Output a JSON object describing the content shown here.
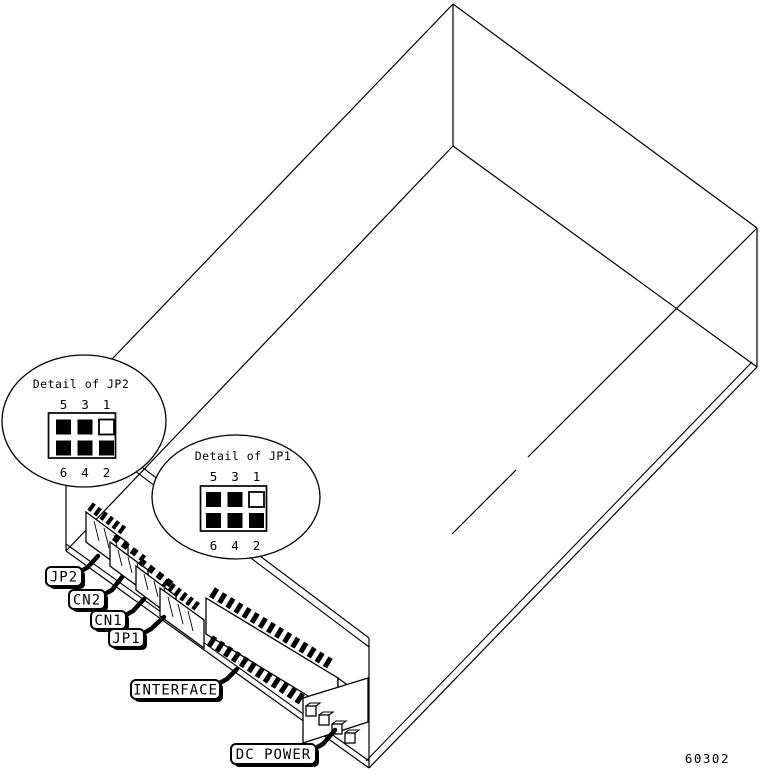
{
  "figure_number": "60302",
  "colors": {
    "line": "#000000",
    "background": "#ffffff"
  },
  "details": {
    "jp2": {
      "title": "Detail of JP2",
      "pins_top": [
        "5",
        "3",
        "1"
      ],
      "pins_bottom": [
        "6",
        "4",
        "2"
      ],
      "cells": [
        {
          "pin": "5",
          "state": "pin-filled"
        },
        {
          "pin": "3",
          "state": "pin-filled"
        },
        {
          "pin": "1",
          "state": "pin-open"
        },
        {
          "pin": "6",
          "state": "pin-filled"
        },
        {
          "pin": "4",
          "state": "pin-filled"
        },
        {
          "pin": "2",
          "state": "pin-filled"
        }
      ]
    },
    "jp1": {
      "title": "Detail of JP1",
      "pins_top": [
        "5",
        "3",
        "1"
      ],
      "pins_bottom": [
        "6",
        "4",
        "2"
      ],
      "cells": [
        {
          "pin": "5",
          "state": "pin-filled"
        },
        {
          "pin": "3",
          "state": "pin-filled"
        },
        {
          "pin": "1",
          "state": "pin-open"
        },
        {
          "pin": "6",
          "state": "pin-filled"
        },
        {
          "pin": "4",
          "state": "pin-filled"
        },
        {
          "pin": "2",
          "state": "pin-filled"
        }
      ]
    }
  },
  "callouts": {
    "jp2": "JP2",
    "cn2": "CN2",
    "cn1": "CN1",
    "jp1": "JP1",
    "interface": "INTERFACE",
    "dc_power": "DC POWER"
  }
}
